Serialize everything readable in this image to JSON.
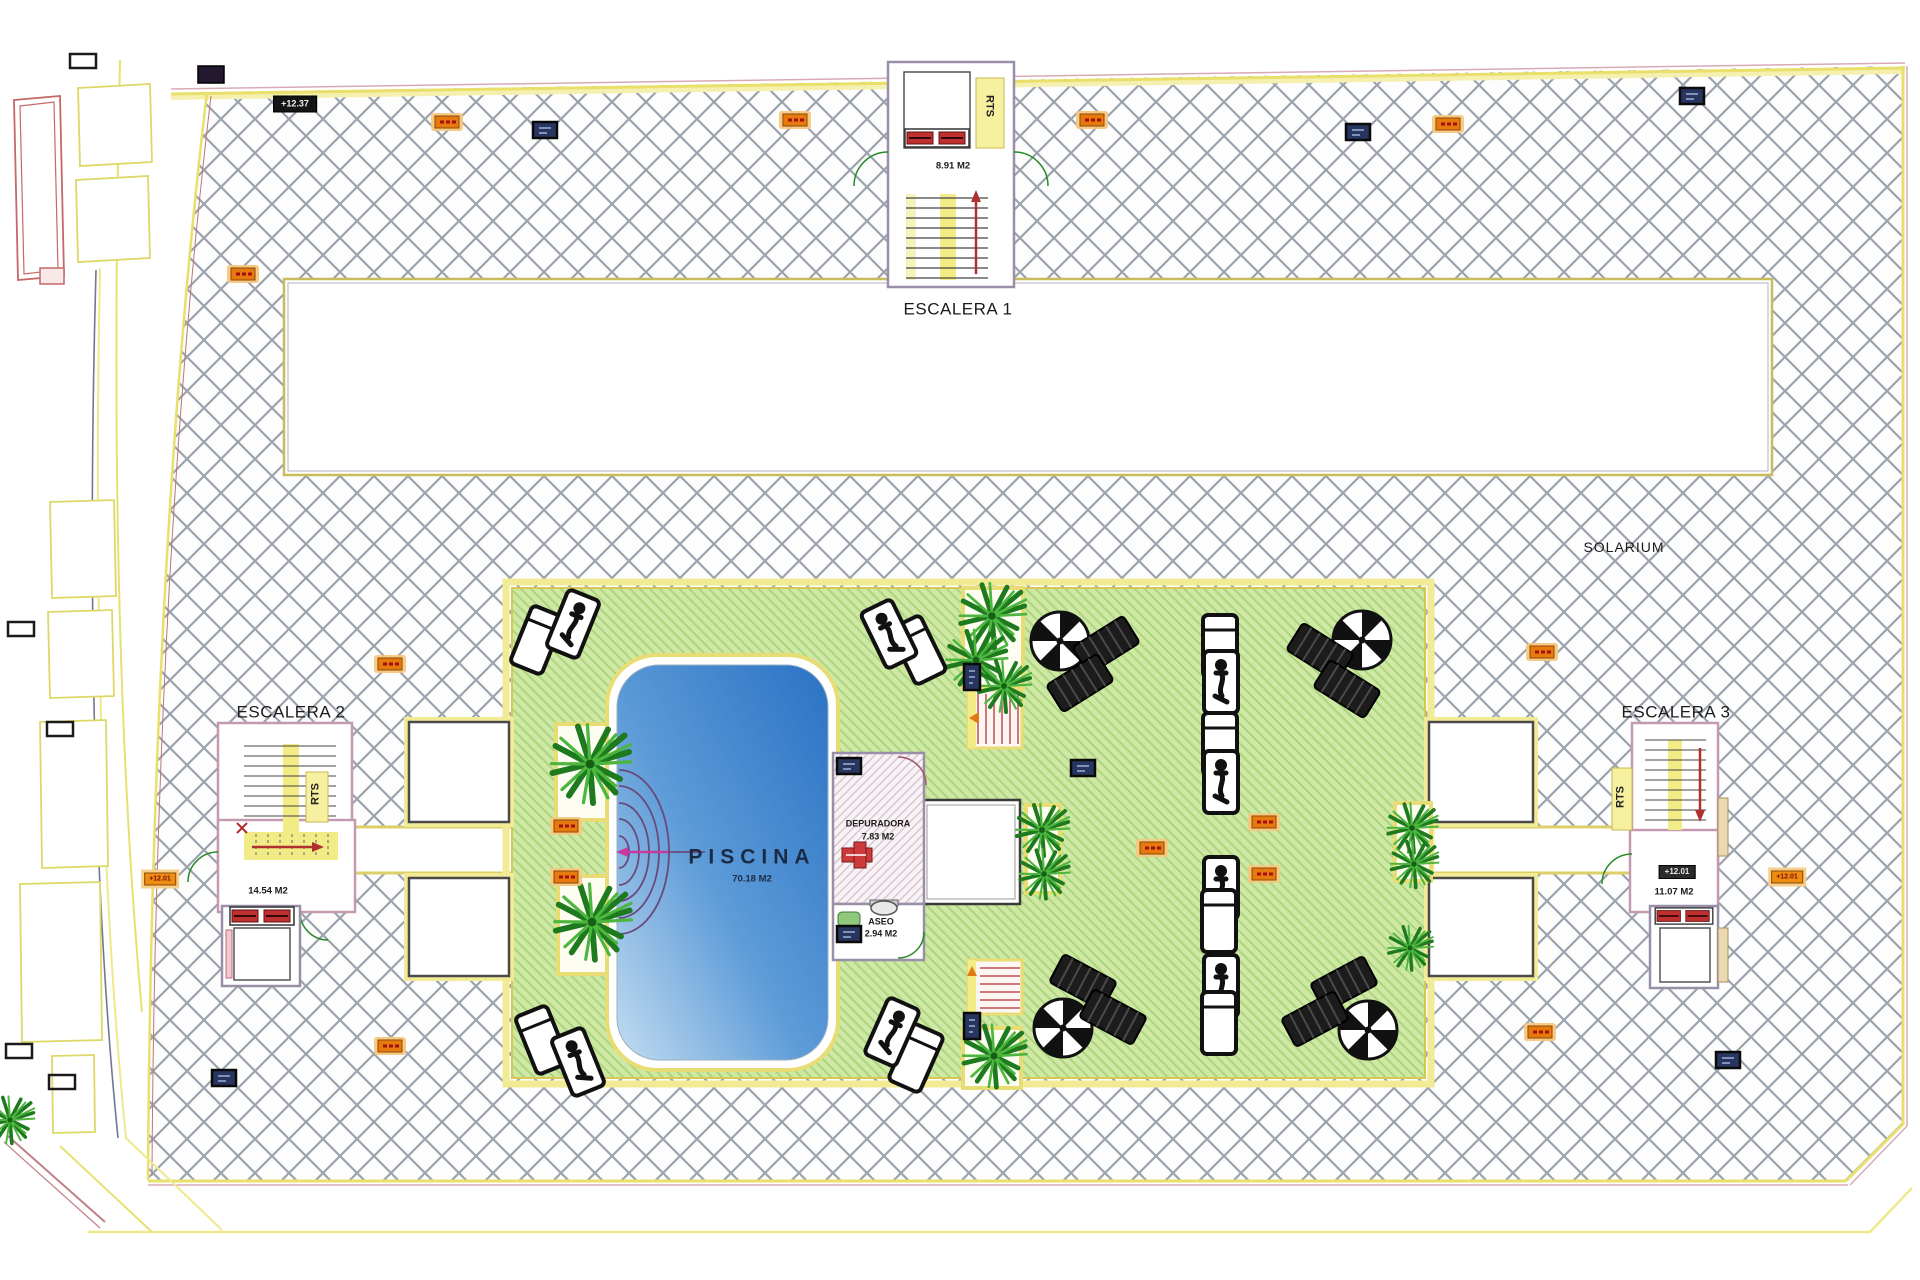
{
  "labels": {
    "escalera1": "ESCALERA 1",
    "escalera2": "ESCALERA 2",
    "escalera3": "ESCALERA 3",
    "solarium": "SOLARIUM",
    "piscina": "PISCINA",
    "piscina_area": "70.18 M2",
    "escalera1_area": "8.91 M2",
    "escalera2_area": "14.54 M2",
    "escalera3_area": "11.07 M2",
    "depuradora": "DEPURADORA",
    "depuradora_area": "7.83 M2",
    "aseo": "ASEO",
    "aseo_area": "2.94 M2",
    "rts": "RTS",
    "level_top": "+12.37",
    "level_mid": "+12.01"
  },
  "colors": {
    "hatch_line": "#9aa2ac",
    "boundary_yellow": "#e8e06a",
    "boundary_pink": "#d8aab8",
    "grass_green": "#cfe8a6",
    "grass_stripe": "#abd67c",
    "deck_yellow": "#f2eb96",
    "pool_blue_deep": "#2a72c4",
    "pool_blue_light": "#c2dcf0",
    "wall_pink": "#c49ab0",
    "stair_yellow": "#f1ec85",
    "arrow_red": "#b03030",
    "door_green": "#2a8a2a",
    "marker_orange": "#e8790f",
    "marker_blue": "#28355e",
    "pump_red": "#c03030"
  },
  "icons": {
    "palm": "palm-tree",
    "parasol": "sun-umbrella",
    "lounger_white": "sun-lounger",
    "lounger_person": "occupied-sun-lounger",
    "lounger_dark": "lounger-mat",
    "marker_orange": "level-marker-orange",
    "marker_blue": "drain-marker-blue",
    "marker_black": "reference-marker-black",
    "elevator": "elevator-machinery",
    "stairs": "stair-flight",
    "pool_steps": "pool-entry-steps"
  }
}
